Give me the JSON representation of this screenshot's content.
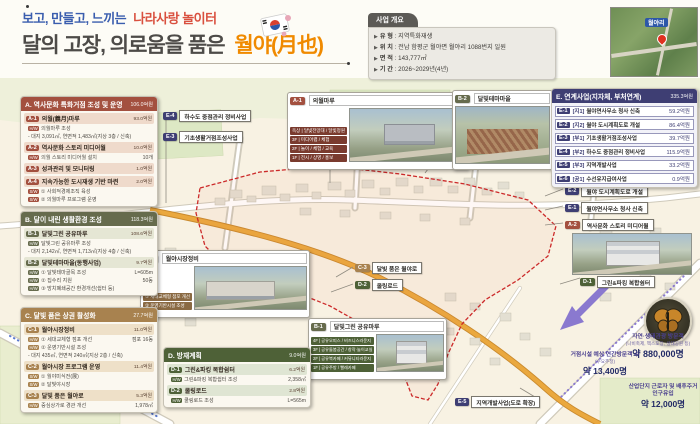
{
  "header": {
    "subtitle": {
      "left": "보고, 만들고, 느끼는",
      "right": "나라사랑 놀이터"
    },
    "title": {
      "left": "달의 고장, 의로움을 품은",
      "right": "월야(月也)"
    }
  },
  "overview": {
    "title": "사업 개요",
    "rows": [
      {
        "label": "유 형",
        "value": "지역특화재생"
      },
      {
        "label": "위 치",
        "value": "전남 함평군 월야면 월야리 1088번지 일원"
      },
      {
        "label": "면 적",
        "value": "143,777㎡"
      },
      {
        "label": "기 간",
        "value": "2026~2029년(4년)"
      }
    ]
  },
  "inset": {
    "place_label": "월야리"
  },
  "colors": {
    "section_a": "#a3503f",
    "section_b": "#666b4d",
    "section_c": "#a8824f",
    "section_d": "#4e6137",
    "section_e": "#3e3e73",
    "title_blue": "#3a5dae",
    "title_red": "#d9503f",
    "title_orange": "#f08a00",
    "boundary_red": "#cc2a2a",
    "road_orange": "#eaa83e",
    "arrow_purple": "#8a79cf"
  },
  "panels": {
    "a": {
      "title": "A. 역사문화 특화거점 조성 및 운영",
      "total": "106.0억원",
      "items": [
        {
          "code": "A-1",
          "name": "의월(義月)마루",
          "value": "93.0억원",
          "subs": [
            {
              "tag": "H/W",
              "text": "의월마루 조성",
              "value": ""
            },
            {
              "tag": "",
              "text": "- 대지 3,091㎡, 연면적 1,483㎡(지상 3층 / 신축)",
              "value": ""
            }
          ]
        },
        {
          "code": "A-2",
          "name": "역사문화 스토리 미디어월",
          "value": "10.0억원",
          "subs": [
            {
              "tag": "H/W",
              "text": "의월 스토리 미디어월 설치",
              "value": "10개"
            }
          ]
        },
        {
          "code": "A-3",
          "name": "성과관리 및 모니터링",
          "value": "1.0억원",
          "subs": []
        },
        {
          "code": "A-4",
          "name": "지속가능한 도시재생 기반 마련",
          "value": "2.0억원",
          "subs": [
            {
              "tag": "S/W",
              "text": "① 사회적경제조직 육성",
              "value": ""
            },
            {
              "tag": "S/W",
              "text": "② 의월마루 프로그램 운영",
              "value": ""
            }
          ]
        }
      ]
    },
    "b": {
      "title": "B. 달이 내린 생활환경 조성",
      "total": "118.3억원",
      "items": [
        {
          "code": "B-1",
          "name": "달빛그린 공유마루",
          "value": "108.6억원",
          "subs": [
            {
              "tag": "H/W",
              "text": "달빛그린 공유마루 조성",
              "value": ""
            },
            {
              "tag": "",
              "text": "- 대지 2,142㎡, 연면적 1,713㎡(지상 4층 / 신축)",
              "value": ""
            }
          ]
        },
        {
          "code": "B-2",
          "name": "달빛테마마을(동행사업)",
          "value": "9.7억원",
          "subs": [
            {
              "tag": "H/W",
              "text": "① 달빛테마골목 조성",
              "value": "L=605m"
            },
            {
              "tag": "H/W",
              "text": "② 집수리 지원",
              "value": "50동"
            },
            {
              "tag": "H/W",
              "text": "③ 방치폐쇄공간 환경개선(쉼터 등)",
              "value": ""
            }
          ]
        }
      ]
    },
    "c": {
      "title": "C. 달빛 품은 상권 활성화",
      "total": "27.7억원",
      "items": [
        {
          "code": "C-1",
          "name": "월야시장정비",
          "value": "11.0억원",
          "subs": [
            {
              "tag": "H/W",
              "text": "① 세대교체형 점포 개선",
              "value": "점포 16동"
            },
            {
              "tag": "H/W",
              "text": "② 운영기반시설 조성",
              "value": ""
            },
            {
              "tag": "",
              "text": "- 대지 435㎡, 연면적 240㎡(지상 2층 / 신축)",
              "value": ""
            }
          ]
        },
        {
          "code": "C-2",
          "name": "월야시장 프로그램 운영",
          "value": "11.4억원",
          "subs": [
            {
              "tag": "S/W",
              "text": "① 월야미식전(展)",
              "value": ""
            },
            {
              "tag": "S/W",
              "text": "② 달빛야시장",
              "value": ""
            }
          ]
        },
        {
          "code": "C-3",
          "name": "달빛 품은 월야로",
          "value": "5.3억원",
          "subs": [
            {
              "tag": "H/W",
              "text": "중심상가로 경관 개선",
              "value": "1,978㎡"
            }
          ]
        }
      ]
    },
    "d": {
      "title": "D. 방재계획",
      "total": "9.0억원",
      "items": [
        {
          "code": "D-1",
          "name": "그린&파킹 복합쉼터",
          "value": "6.2억원",
          "subs": [
            {
              "tag": "H/W",
              "text": "그린&파킹 복합쉼터 조성",
              "value": "2,358㎡"
            }
          ]
        },
        {
          "code": "D-2",
          "name": "쿨링로드",
          "value": "2.8억원",
          "subs": [
            {
              "tag": "H/W",
              "text": "쿨링로드 조성",
              "value": "L=565m"
            }
          ]
        }
      ]
    },
    "e": {
      "title": "E. 연계사업(지자체, 부처연계)",
      "total": "335.3억원",
      "items": [
        {
          "code": "E-1",
          "bracket": "[지1]",
          "name": "월야면사무소 청사 신축",
          "value": "59.2억원"
        },
        {
          "code": "E-2",
          "bracket": "[지2]",
          "name": "월야 도시계획도로 개설",
          "value": "86.4억원"
        },
        {
          "code": "E-3",
          "bracket": "[부1]",
          "name": "기초생활거점조성사업",
          "value": "39.7억원"
        },
        {
          "code": "E-4",
          "bracket": "[부2]",
          "name": "하수도 중점관리 정비사업",
          "value": "115.9억원"
        },
        {
          "code": "E-5",
          "bracket": "[부3]",
          "name": "지역개발사업",
          "value": "33.2억원"
        },
        {
          "code": "E-6",
          "bracket": "[공1]",
          "name": "수선유지급여사업",
          "value": "0.9억원"
        }
      ]
    }
  },
  "map": {
    "callouts": {
      "a1": {
        "code": "A-1",
        "title": "의월마루",
        "floors": [
          "옥상 | 달빛전망대 / 달빛정원",
          "3F | 미디어랩 / 체험",
          "2F | 놀이 / 체험 / 교육",
          "1F | 전시 / 상영 / 홍보"
        ]
      },
      "b2": {
        "code": "B-2",
        "title": "달빛테마마을"
      },
      "c1": {
        "code": "C-1",
        "title": "월야시장정비",
        "rows": [
          "① 세대교체형 점포 개선",
          "② 운영기반시설 조성"
        ]
      },
      "b1": {
        "code": "B-1",
        "title": "달빛그린 공유마루",
        "floors": [
          "4F | 공유오피스 / 비즈니스라운지",
          "3F | 공유돌봄공간 / 창작·놀이교실",
          "2F | 공유북카페 / 커뮤니티라운지",
          "1F | 공유주방 / 빨래카페"
        ]
      }
    },
    "labels": {
      "e4": {
        "code": "E-4",
        "title": "하수도 중점관리 정비사업"
      },
      "e3": {
        "code": "E-3",
        "title": "기초생활거점조성사업"
      },
      "c3": {
        "code": "C-3",
        "title": "달빛 품은 월야로"
      },
      "d2": {
        "code": "D-2",
        "title": "쿨링로드"
      },
      "e5": {
        "code": "E-5",
        "title": "지역개발사업(도로 확장)"
      },
      "e2": {
        "code": "E-2",
        "title": "월야 도시계획도로 개설"
      },
      "e1": {
        "code": "E-1",
        "title": "월야면사무소 청사 신축"
      },
      "a2": {
        "code": "A-2",
        "title": "역사문화 스토리 미디어월"
      },
      "d1": {
        "code": "D-1",
        "title": "그린&파킹 복합쉼터"
      }
    },
    "stats": [
      {
        "title": "자연·생태관광 방문객",
        "sub": "(나비축제, 엑스포장, 생태공원 등)",
        "value": "약 880,000명"
      },
      {
        "title": "거점시설 예상 연간방문객 수",
        "sub": "(수요추정)",
        "value": "약 13,400명"
      },
      {
        "title": "산업단지 근로자 및 배후주거 인구유입",
        "sub": "",
        "value": "약 12,000명"
      }
    ]
  }
}
